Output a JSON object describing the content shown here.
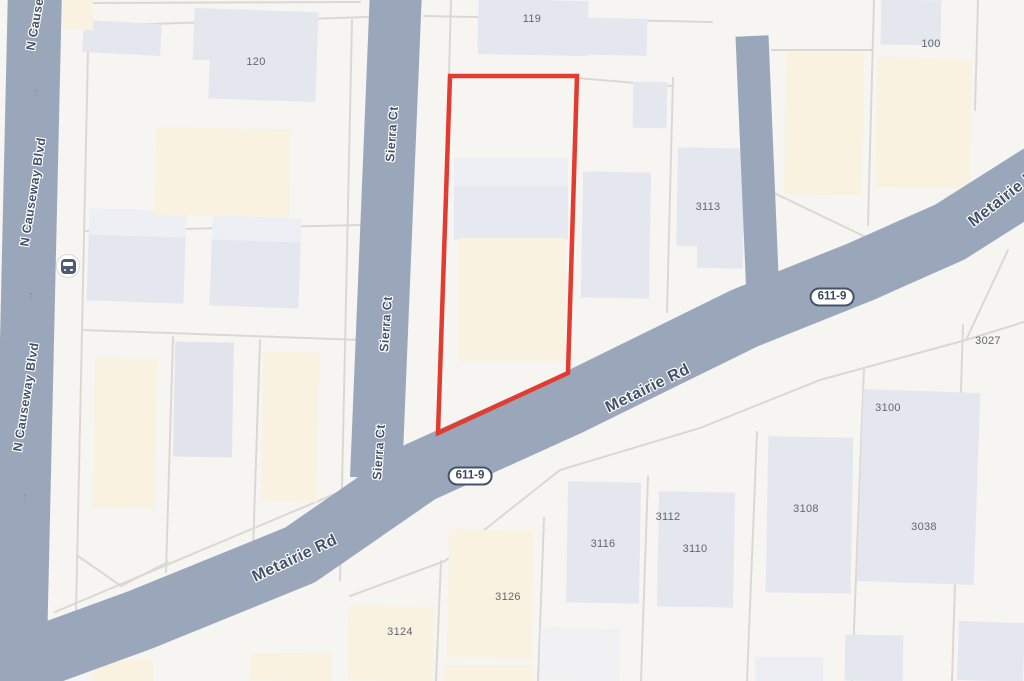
{
  "map": {
    "roads": {
      "metairie": {
        "label": "Metairie Rd",
        "route": "611-9"
      },
      "causeway": {
        "label": "N Causeway Blvd"
      },
      "sierra": {
        "label": "Sierra Ct"
      }
    },
    "road_labels": [
      {
        "text": "N Causeway Blvd",
        "x": 40,
        "y": -4,
        "rot": -80,
        "cls": "minor"
      },
      {
        "text": "N Causeway Blvd",
        "x": 33,
        "y": 192,
        "rot": -81,
        "cls": "minor"
      },
      {
        "text": "N Causeway Blvd",
        "x": 26,
        "y": 397,
        "rot": -81,
        "cls": "minor"
      },
      {
        "text": "Sierra Ct",
        "x": 392,
        "y": 134,
        "rot": -86,
        "cls": "minor"
      },
      {
        "text": "Sierra Ct",
        "x": 386,
        "y": 324,
        "rot": -86,
        "cls": "minor"
      },
      {
        "text": "Sierra Ct",
        "x": 379,
        "y": 452,
        "rot": -86,
        "cls": "minor"
      },
      {
        "text": "Metairie Rd",
        "x": 295,
        "y": 559,
        "rot": -25,
        "cls": "major"
      },
      {
        "text": "Metairie Rd",
        "x": 648,
        "y": 389,
        "rot": -26,
        "cls": "major"
      },
      {
        "text": "Metairie Rd",
        "x": 1007,
        "y": 196,
        "rot": -38,
        "cls": "major"
      }
    ],
    "route_shields": [
      {
        "text": "611-9",
        "x": 832,
        "y": 297
      },
      {
        "text": "611-9",
        "x": 470,
        "y": 476
      }
    ],
    "parcel_labels": [
      {
        "text": "119",
        "x": 532,
        "y": 19
      },
      {
        "text": "120",
        "x": 256,
        "y": 62
      },
      {
        "text": "100",
        "x": 931,
        "y": 44
      },
      {
        "text": "3113",
        "x": 708,
        "y": 207
      },
      {
        "text": "3027",
        "x": 988,
        "y": 341
      },
      {
        "text": "3100",
        "x": 888,
        "y": 408
      },
      {
        "text": "3108",
        "x": 806,
        "y": 509
      },
      {
        "text": "3112",
        "x": 668,
        "y": 517
      },
      {
        "text": "3110",
        "x": 695,
        "y": 549
      },
      {
        "text": "3116",
        "x": 603,
        "y": 544
      },
      {
        "text": "3038",
        "x": 924,
        "y": 527
      },
      {
        "text": "3126",
        "x": 508,
        "y": 597
      },
      {
        "text": "3124",
        "x": 400,
        "y": 632
      }
    ],
    "oneway_arrows": [
      {
        "glyph": "↑",
        "x": 36,
        "y": 92
      },
      {
        "glyph": "↑",
        "x": 31,
        "y": 295
      },
      {
        "glyph": "↑",
        "x": 25,
        "y": 497
      }
    ],
    "poi": {
      "bus_stop": {
        "x": 68,
        "y": 266
      }
    },
    "colors": {
      "background": "#f6f5f2",
      "road": "#9aa7bb",
      "parcel_line": "#dbd8d3",
      "building_gray": "#e4e7ee",
      "building_gray_light": "#edeff5",
      "building_beige": "#f9f2e1",
      "subject_outline_red": "#e23b30",
      "road_label_text": "#44506a",
      "parcel_label_text": "#63666d"
    }
  }
}
